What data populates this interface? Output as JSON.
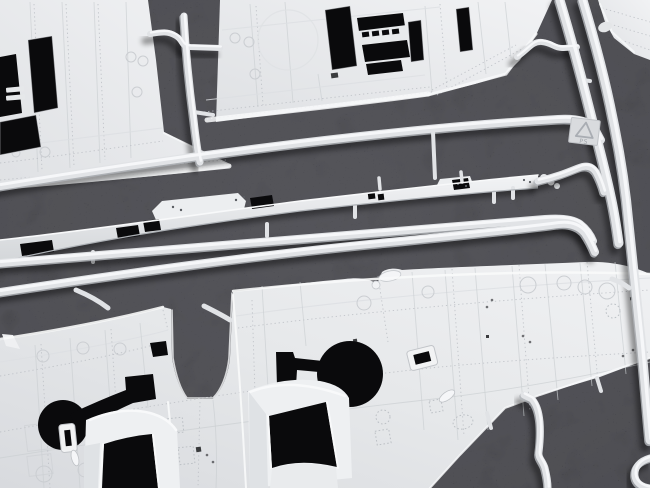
{
  "scene": {
    "description": "Macro photograph of a light grey injection-moulded plastic model kit sprue with aircraft wing parts, lying on dark black fabric",
    "material_marking": "PS",
    "parts": [
      "upper-wing-half-left",
      "upper-wing-half-center",
      "wing-tip-fragment",
      "wing-spar-strip",
      "one-piece-lower-wing",
      "sprue-runner-frame",
      "recycling-code-tab"
    ],
    "colors": {
      "fabric": "#1a1a1d",
      "cutout": "#0a0a0c",
      "plastic": "#e8e9eb",
      "plastic_bright": "#f8f9fa",
      "plastic_shadow": "#c9ccd0",
      "runner": "#e1e3e6",
      "runner_highlight": "#f7f8fa",
      "runner_shade": "#b0b4b9",
      "panel_line": "#cbced2",
      "rivet": "#bcc0c5"
    }
  }
}
